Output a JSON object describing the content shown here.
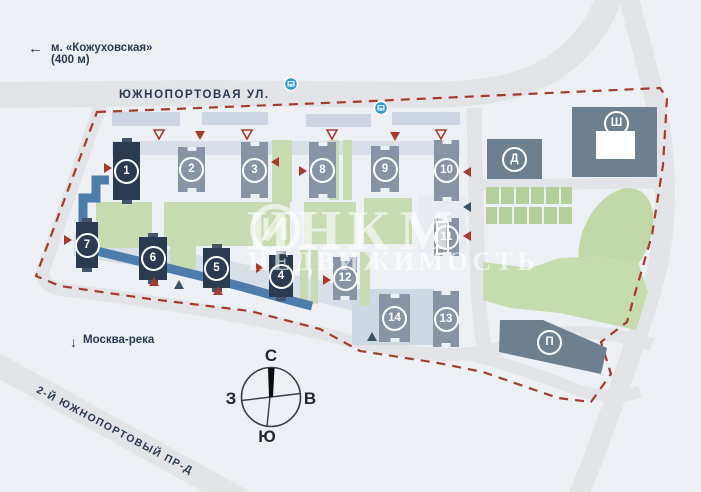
{
  "map": {
    "metro_label": "м. «Кожуховская»",
    "metro_distance": "(400 м)",
    "street_main": "ЮЖНОПОРТОВАЯ УЛ.",
    "street_secondary": "2-Й ЮЖНОПОРТОВЫЙ ПР-Д",
    "river_label": "Москва-река",
    "compass": {
      "n": "С",
      "s": "Ю",
      "w": "З",
      "e": "В"
    },
    "watermark": {
      "part1": "ИНК",
      "part2": "М",
      "line2": "НЕДВИЖИМОСТЬ"
    },
    "buildings": {
      "b1": "1",
      "b2": "2",
      "b3": "3",
      "b4": "4",
      "b5": "5",
      "b6": "6",
      "b7": "7",
      "b8": "8",
      "b9": "9",
      "b10": "10",
      "b11": "11",
      "b12": "12",
      "b13": "13",
      "b14": "14",
      "bd": "Д",
      "bsh": "Ш",
      "bp": "П"
    },
    "colors": {
      "background": "#edf1f6",
      "road": "#e2e4e8",
      "building_dark": "#2b3a50",
      "building_gray": "#8894a5",
      "building_slate": "#6e8090",
      "green": "#c9dbb2",
      "boundary_red": "#a63a2b",
      "walkway_blue": "#4e7dab",
      "bus_blue": "#2e9ad2"
    }
  }
}
